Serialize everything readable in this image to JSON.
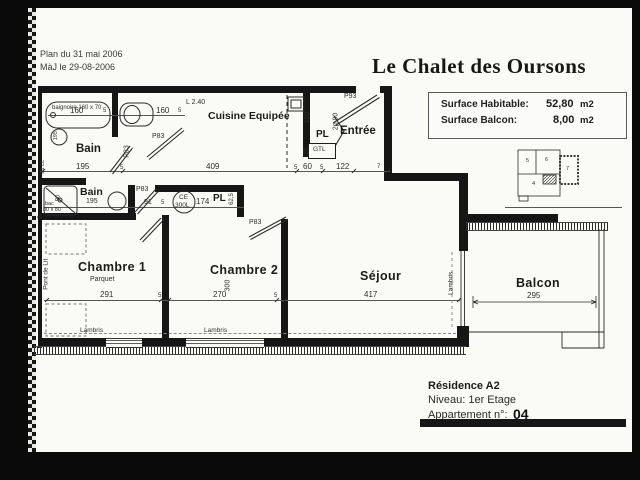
{
  "page": {
    "plan_date": "Plan du 31 mai 2006",
    "maj_date": "MàJ le 29-08-2006"
  },
  "header": {
    "title": "Le Chalet des Oursons",
    "surfaces": {
      "habitable_label": "Surface Habitable:",
      "habitable_value": "52,80",
      "habitable_unit": "m2",
      "balcon_label": "Surface Balcon:",
      "balcon_value": "8,00",
      "balcon_unit": "m2"
    }
  },
  "locator": {
    "u5": "5",
    "u6": "6",
    "u7": "7",
    "u4": "4"
  },
  "footer": {
    "residence": "Résidence A2",
    "niveau": "Niveau: 1er Etage",
    "apt_label": "Appartement n°:",
    "apt_num": "04"
  },
  "rooms": {
    "bain1": "Bain",
    "bain2": "Bain",
    "cuisine": "Cuisine Equipée",
    "entree": "Entrée",
    "pl_entree": "PL",
    "pl_ch2": "PL",
    "gtl": "GTL",
    "chambre1": "Chambre 1",
    "parquet": "Parquet",
    "chambre2": "Chambre 2",
    "sejour": "Séjour",
    "balcon": "Balcon"
  },
  "doors": {
    "p83_wc": "P83",
    "p83_bain1": "P83",
    "p83_bain2": "P83",
    "p83_ch2": "P83",
    "p93_entree": "P93",
    "pl_door": "2p 90"
  },
  "fixtures": {
    "baignoire": "baignoire 160 x 70",
    "bac_line1": "bac",
    "bac_line2": "80 x 80",
    "ce_line1": "CE",
    "ce_line2": "300L",
    "ad_ll": "ad LL",
    "pont_de_lit": "Pont de Lit",
    "lambris_ch1": "Lambris",
    "lambris_ch2": "Lambris",
    "lambris_sejour": "Lambris"
  },
  "dims": {
    "baignoire_160": "160",
    "baignoire_5": "5",
    "wc_160": "160",
    "wc_5": "5",
    "l240": "L 2.40",
    "bain1_195": "195",
    "t171_5a": "5",
    "cuisine_409": "409",
    "t171_5b": "5",
    "hall_60": "60",
    "t171_5c": "5",
    "entree_122": "122",
    "entree_7": "7",
    "pl_110": "110",
    "pl_25": "25",
    "bain2_195": "195",
    "bain2_91": "91",
    "t207_5": "5",
    "pl2_174": "174",
    "pl2_625": "62,5",
    "bac_80": "80",
    "bac_5": "5",
    "basin_195": "195",
    "ch1_291": "291",
    "t300_5a": "5",
    "ch2_270": "270",
    "t300_5b": "5",
    "ch2_300": "300",
    "sejour_417": "417",
    "balcon_295": "295"
  }
}
